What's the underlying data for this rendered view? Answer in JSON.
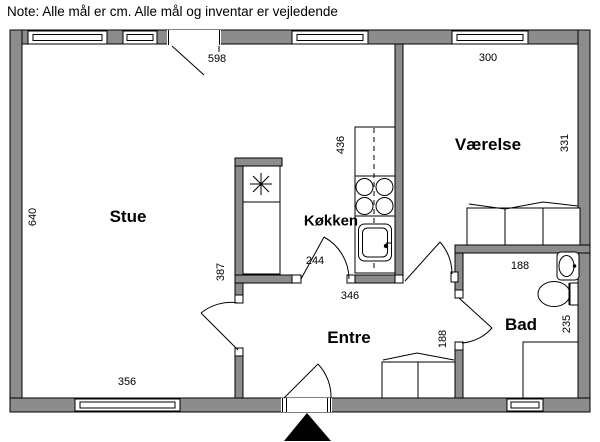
{
  "note": "Note: Alle mål er cm. Alle mål og inventar er vejledende",
  "rooms": {
    "stue": "Stue",
    "koekken": "Køkken",
    "vaerelse": "Værelse",
    "entre": "Entre",
    "bad": "Bad"
  },
  "dims": {
    "terrace_opening": "598",
    "vaerelse_width": "300",
    "vaerelse_depth": "331",
    "koekken_counter": "436",
    "stue_depth": "640",
    "stue_inner": "387",
    "koekken_opening": "244",
    "koekken_width": "346",
    "stue_window": "356",
    "entre_passage": "188",
    "bad_width": "188",
    "bad_depth": "235"
  },
  "fixtures": [
    "fridge-freezer-star",
    "kitchen-counter",
    "stove-4-burner",
    "kitchen-sink",
    "wardrobe-vaerelse",
    "wardrobe-entre",
    "washbasin",
    "toilet",
    "shower",
    "entrance-arrow"
  ],
  "colors": {
    "wall": "#8c8c8c",
    "line": "#000000",
    "bg": "#ffffff"
  }
}
